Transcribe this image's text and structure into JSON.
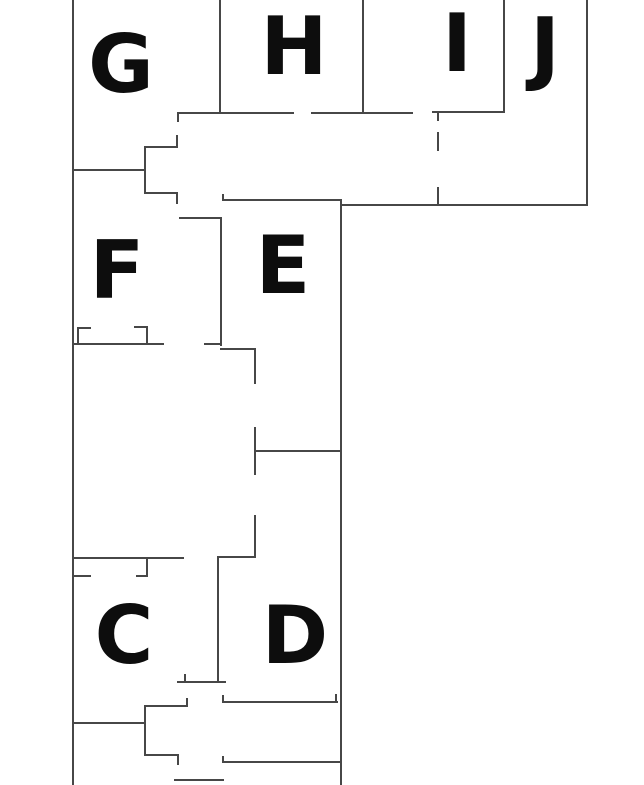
{
  "canvas": {
    "width": 644,
    "height": 785,
    "background": "#ffffff"
  },
  "style": {
    "wall_color": "#474747",
    "wall_width": 2,
    "label_color": "#0d0d0d",
    "label_font_size": 80
  },
  "rooms": [
    {
      "label": "G",
      "cx": 121,
      "cy": 63
    },
    {
      "label": "H",
      "cx": 294,
      "cy": 45
    },
    {
      "label": "I",
      "cx": 457,
      "cy": 42
    },
    {
      "label": "J",
      "cx": 545,
      "cy": 46
    },
    {
      "label": "F",
      "cx": 117,
      "cy": 269
    },
    {
      "label": "E",
      "cx": 283,
      "cy": 264
    },
    {
      "label": "C",
      "cx": 124,
      "cy": 634
    },
    {
      "label": "D",
      "cx": 295,
      "cy": 634
    }
  ],
  "walls": [
    [
      73,
      0,
      73,
      785
    ],
    [
      220,
      0,
      220,
      113
    ],
    [
      363,
      0,
      363,
      113
    ],
    [
      504,
      0,
      504,
      112
    ],
    [
      587,
      0,
      587,
      205
    ],
    [
      178,
      113,
      178,
      121
    ],
    [
      438,
      113,
      438,
      120
    ],
    [
      438,
      133,
      438,
      150
    ],
    [
      438,
      188,
      438,
      205
    ],
    [
      177,
      136,
      177,
      147
    ],
    [
      145,
      147,
      145,
      193
    ],
    [
      177,
      193,
      177,
      203
    ],
    [
      223,
      195,
      223,
      200
    ],
    [
      341,
      200,
      341,
      785
    ],
    [
      221,
      218,
      221,
      345
    ],
    [
      255,
      349,
      255,
      383
    ],
    [
      255,
      428,
      255,
      474
    ],
    [
      255,
      516,
      255,
      557
    ],
    [
      78,
      328,
      78,
      344
    ],
    [
      147,
      327,
      147,
      344
    ],
    [
      147,
      558,
      147,
      576
    ],
    [
      218,
      557,
      218,
      682
    ],
    [
      185,
      675,
      185,
      682
    ],
    [
      187,
      699,
      187,
      706
    ],
    [
      145,
      706,
      145,
      755
    ],
    [
      178,
      755,
      178,
      764
    ],
    [
      223,
      696,
      223,
      702
    ],
    [
      336,
      695,
      336,
      702
    ],
    [
      223,
      757,
      223,
      762
    ],
    [
      178,
      113,
      293,
      113
    ],
    [
      312,
      113,
      412,
      113
    ],
    [
      433,
      112,
      504,
      112
    ],
    [
      145,
      147,
      177,
      147
    ],
    [
      73,
      170,
      145,
      170
    ],
    [
      145,
      193,
      177,
      193
    ],
    [
      223,
      200,
      341,
      200
    ],
    [
      341,
      205,
      587,
      205
    ],
    [
      180,
      218,
      221,
      218
    ],
    [
      73,
      344,
      163,
      344
    ],
    [
      205,
      344,
      221,
      344
    ],
    [
      221,
      349,
      255,
      349
    ],
    [
      78,
      328,
      90,
      328
    ],
    [
      135,
      327,
      147,
      327
    ],
    [
      255,
      451,
      341,
      451
    ],
    [
      73,
      558,
      183,
      558
    ],
    [
      218,
      557,
      255,
      557
    ],
    [
      73,
      576,
      90,
      576
    ],
    [
      137,
      576,
      147,
      576
    ],
    [
      178,
      682,
      225,
      682
    ],
    [
      145,
      706,
      187,
      706
    ],
    [
      223,
      702,
      337,
      702
    ],
    [
      73,
      723,
      145,
      723
    ],
    [
      145,
      755,
      178,
      755
    ],
    [
      223,
      762,
      341,
      762
    ],
    [
      175,
      780,
      223,
      780
    ]
  ]
}
